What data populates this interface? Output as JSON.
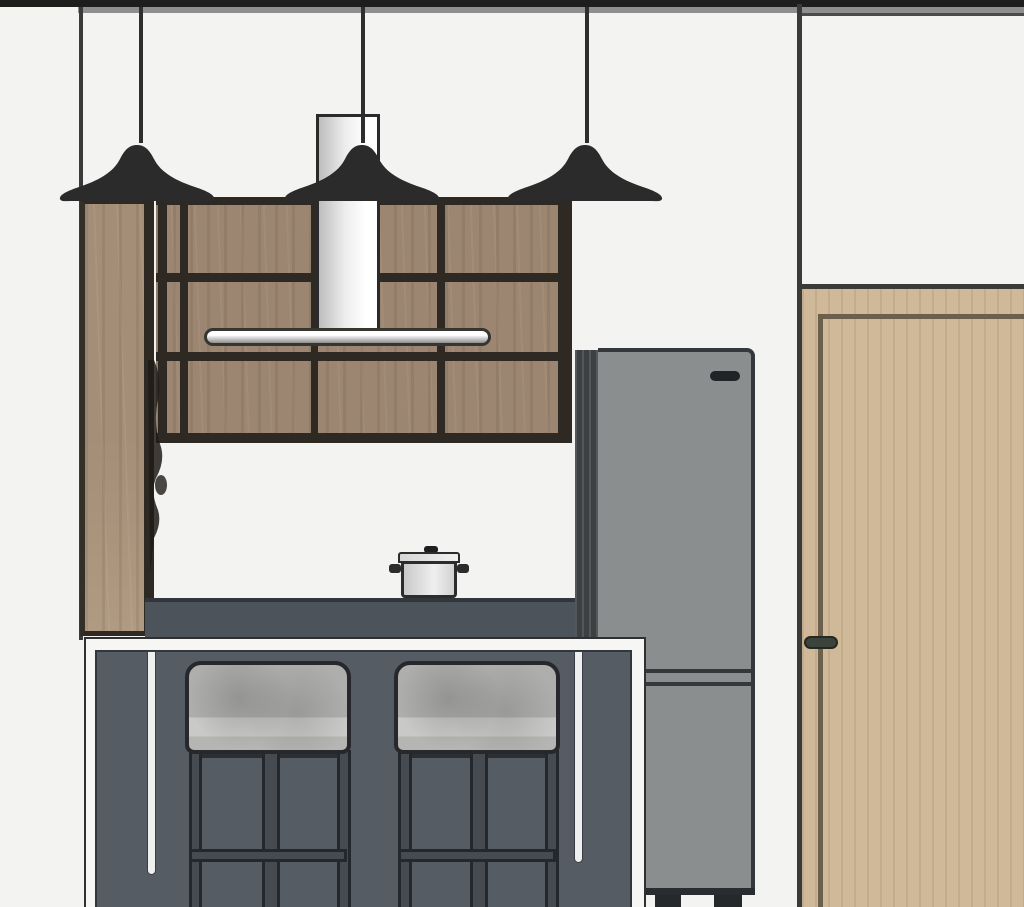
{
  "scene": {
    "title": "Kitchen interior elevation rendering",
    "style": "SketchUp-like 3D elevation, no visible text or UI chrome",
    "objects": [
      {
        "name": "ceiling-soffit-band",
        "color": "#1d1d1d"
      },
      {
        "name": "pendant-lamp",
        "count": 3,
        "shade_color": "#2b2b2b"
      },
      {
        "name": "wall-cabinets-wood-grid",
        "color": "#9c8671",
        "frame_color": "#2e2a23"
      },
      {
        "name": "range-hood-duct",
        "color": "#ffffff"
      },
      {
        "name": "range-hood-canopy",
        "color": "#d9d9d9"
      },
      {
        "name": "tall-wood-side-panel",
        "color": "#a58e77"
      },
      {
        "name": "countertop",
        "color": "#4d535a"
      },
      {
        "name": "cooking-pot-with-lid",
        "color": "#efefef"
      },
      {
        "name": "kitchen-island-with-white-frame",
        "panel_color": "#565c64",
        "frame_color": "#f6f6f5"
      },
      {
        "name": "bar-stool",
        "count": 2,
        "cushion_color": "#aeaeac",
        "leg_color": "#464b52"
      },
      {
        "name": "refrigerator-two-door",
        "body_color": "#8b8e8f",
        "side_color": "#3d4043"
      },
      {
        "name": "interior-door-wood",
        "color": "#cfb998",
        "handle_color": "#3c423c"
      },
      {
        "name": "wall-corner-lines",
        "color": "#3a3a3a"
      }
    ]
  },
  "palette": {
    "wall": "#f3f3f2",
    "ceiling_black": "#1d1d1d",
    "ceiling_gray": "#8e8e8e",
    "line_dark": "#3a3a3a",
    "cabinet_wood": "#9c8671",
    "cabinet_frame": "#2e2a23",
    "panel_wood": "#a58e77",
    "duct_fill_a": "#bdbdbd",
    "duct_fill_b": "#ffffff",
    "duct_outline": "#2a2a2a",
    "hood_bar_a": "#ffffff",
    "hood_bar_b": "#8f8f8f",
    "hood_outline": "#36352f",
    "pendant_black": "#2b2b2b",
    "counter": "#4d535a",
    "counter_edge": "#31363c",
    "island_frame": "#f6f6f5",
    "island_panel": "#565c64",
    "island_outline": "#303030",
    "pinstripe": "#eef0f0",
    "cushion": "#aeaeac",
    "cushion_hi": "#c9c9c7",
    "stool_outline": "#26282b",
    "stool_leg": "#464b52",
    "fridge_body": "#8b8e8f",
    "fridge_strip": "#3d4043",
    "fridge_line": "#34383b",
    "fridge_dark": "#212426",
    "door_wood": "#cfb998",
    "door_frame": "#6c604c",
    "door_handle": "#3c423c",
    "pot_light": "#efefef",
    "pot_mid": "#c9c9c9",
    "pot_outline": "#2c2c2c",
    "shadow_blob": "#1f1b16"
  }
}
